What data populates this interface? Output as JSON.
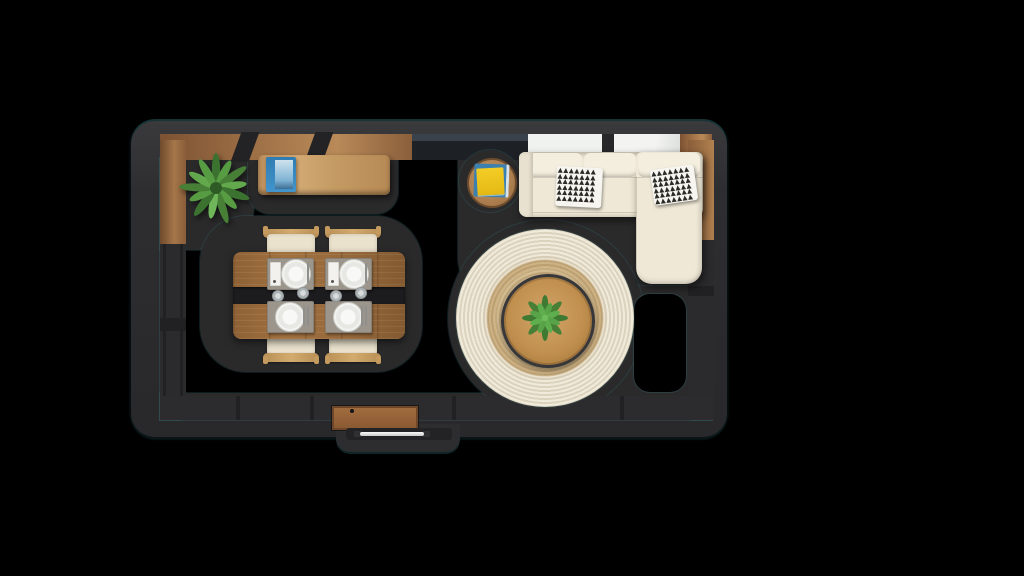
{
  "scene": {
    "title": "top-down room interior render",
    "type": "3d-floorplan-bird-eye-view",
    "room": "open living and dining room with dark charcoal walls, wood wall panels and glass sections"
  },
  "colors": {
    "background": "#000000",
    "wall": "#2e2e30",
    "wall_face": "#2b2b2d",
    "floor_shadow": "#2a2a2b",
    "teal_rim": "#3a8088",
    "wood_wall": "#a5764a",
    "wood_sideboard": "#c9a06a",
    "wood_table": "#96693c",
    "wood_chair": "#c59a5e",
    "sofa_cream": "#efe8d6",
    "cushion_cream": "#eae2cd",
    "pillow_white": "#f7f5f0",
    "pillow_print": "#2c2a26",
    "rug_cream": "#efe9d8",
    "rug_jute": "#d0b384",
    "coffee_table_wood": "#c1904f",
    "plant_green": "#5a9e45",
    "plant_dark_green": "#3c7230",
    "placemat_gray": "#9b958b",
    "plate_white": "#f2f2ef",
    "runner_black": "#1c1c1e",
    "book_blue": "#3b80af",
    "book_yellow": "#f1c81f",
    "doormat_brown": "#9c6a3e",
    "window_white": "#f0f2f0",
    "glass_dark": "#21262b"
  },
  "furniture": {
    "corner_plant": {
      "name": "potted leafy plant",
      "position": "top-left corner on wood panel wall"
    },
    "sideboard": {
      "name": "wooden sideboard",
      "items_on_top": [
        "blue book"
      ]
    },
    "side_table": {
      "name": "round wooden side table",
      "items_on_top": [
        "blue book",
        "yellow book"
      ]
    },
    "sofa": {
      "name": "L-shaped cream sectional sofa",
      "pillow_count": 2,
      "pillow_pattern": "black triangle print",
      "pillow_glyphs": "▲▲▲▲▲▲▲\n▲▲▲▲▲▲▲\n▲▲▲▲▲▲▲\n▲▲▲▲▲▲▲\n▲▲▲▲▲▲▲\n▲▲▲▲▲▲▲"
    },
    "rug": {
      "name": "round jute rug with cream border"
    },
    "coffee_table": {
      "name": "round wooden coffee table",
      "items_on_top": [
        "green succulent plant"
      ]
    },
    "dining": {
      "table": "wooden dining table with black center runner",
      "chairs": 4,
      "place_settings": 4,
      "glasses": 4,
      "placemats": 4
    },
    "entry": {
      "doormat": "brown doormat",
      "door": "door with metal pull handle"
    },
    "windows": {
      "bright_panes": 2,
      "dark_glass_panes": 1
    }
  }
}
